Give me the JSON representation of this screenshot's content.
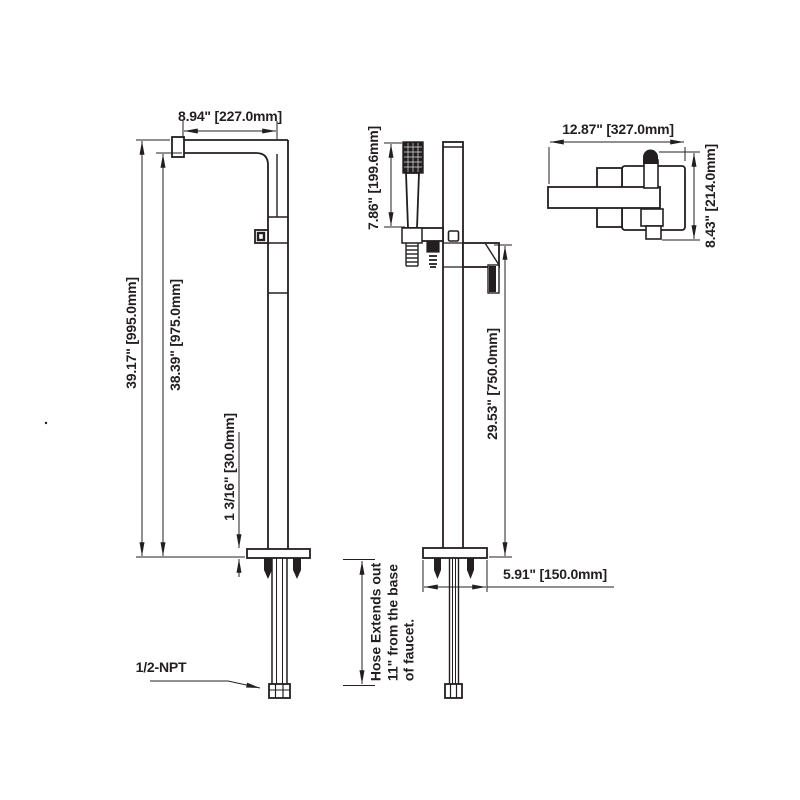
{
  "colors": {
    "line": "#231f20",
    "background": "#ffffff"
  },
  "front_view": {
    "spout_reach": "8.94\" [227.0mm]",
    "overall_height": "39.17\" [995.0mm]",
    "spout_height": "38.39\" [975.0mm]",
    "base_thickness": "1 3/16\" [30.0mm]",
    "inlet_thread": "1/2-NPT"
  },
  "side_view": {
    "handshower_length": "7.86\" [199.6mm]",
    "outlet_height": "29.53\" [750.0mm]",
    "base_width": "5.91\" [150.0mm]",
    "hose_note": {
      "line1": "Hose Extends out",
      "line2": "11\" from the base",
      "line3": "of faucet."
    }
  },
  "top_view": {
    "overall_reach": "12.87\" [327.0mm]",
    "overall_depth": "8.43\" [214.0mm]"
  }
}
